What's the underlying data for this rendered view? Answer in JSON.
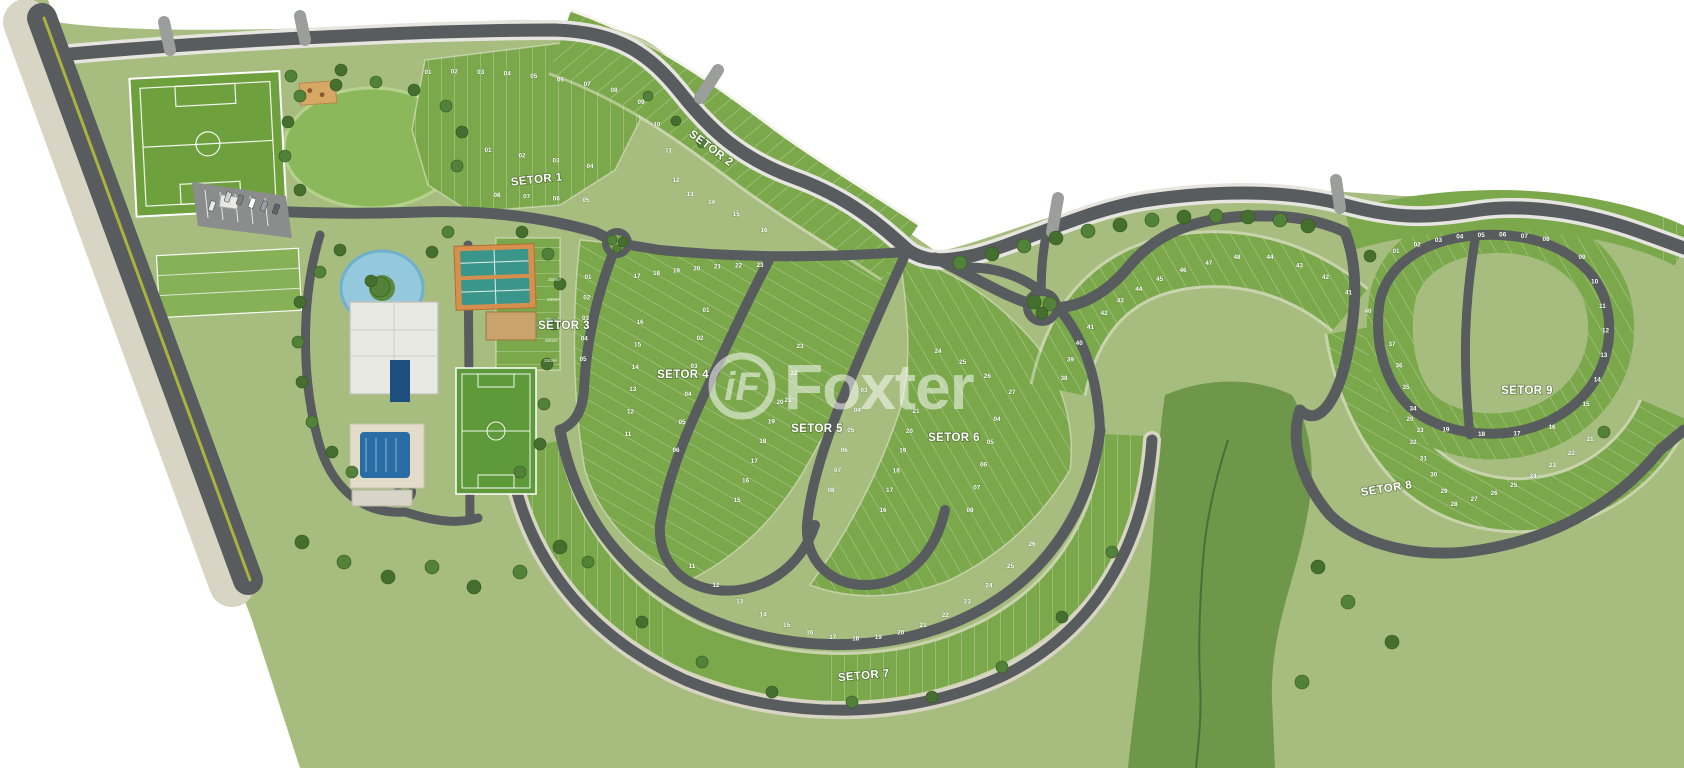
{
  "title": "Condominium master plan map",
  "watermark": {
    "brand": "Foxter",
    "icon_glyph": "iF"
  },
  "sector_labels": [
    {
      "id": "setor-1",
      "label": "SETOR 1",
      "x": 537,
      "y": 183,
      "rot": -6
    },
    {
      "id": "setor-2",
      "label": "SETOR 2",
      "x": 709,
      "y": 151,
      "rot": 37
    },
    {
      "id": "setor-3",
      "label": "SETOR 3",
      "x": 564,
      "y": 329,
      "rot": 0
    },
    {
      "id": "setor-4",
      "label": "SETOR 4",
      "x": 683,
      "y": 378,
      "rot": 0
    },
    {
      "id": "setor-5",
      "label": "SETOR 5",
      "x": 817,
      "y": 432,
      "rot": 0
    },
    {
      "id": "setor-6",
      "label": "SETOR 6",
      "x": 954,
      "y": 441,
      "rot": 0
    },
    {
      "id": "setor-7",
      "label": "SETOR 7",
      "x": 864,
      "y": 679,
      "rot": -5
    },
    {
      "id": "setor-8",
      "label": "SETOR 8",
      "x": 1387,
      "y": 492,
      "rot": -9
    },
    {
      "id": "setor-9",
      "label": "SETOR 9",
      "x": 1527,
      "y": 394,
      "rot": 0
    }
  ],
  "lot_rows": [
    {
      "sector": "setor-1",
      "numbers": [
        "01",
        "02",
        "03",
        "04"
      ],
      "from": [
        488,
        152
      ],
      "to": [
        590,
        168
      ]
    },
    {
      "sector": "setor-1",
      "numbers": [
        "08",
        "07",
        "06",
        "05"
      ],
      "from": [
        497,
        197
      ],
      "to": [
        586,
        202
      ]
    },
    {
      "sector": "setor-2",
      "numbers": [
        "01",
        "02",
        "03",
        "04",
        "05",
        "06",
        "07",
        "08"
      ],
      "from": [
        428,
        74
      ],
      "ctrl": [
        520,
        70
      ],
      "to": [
        614,
        92
      ]
    },
    {
      "sector": "setor-2",
      "numbers": [
        "09",
        "10",
        "11",
        "12"
      ],
      "from": [
        641,
        104
      ],
      "ctrl": [
        668,
        135
      ],
      "to": [
        676,
        182
      ]
    },
    {
      "sector": "setor-2",
      "numbers": [
        "13",
        "14",
        "15",
        "16"
      ],
      "from": [
        690,
        196
      ],
      "ctrl": [
        720,
        205
      ],
      "to": [
        764,
        232
      ]
    },
    {
      "sector": "setor-3",
      "numbers": [
        "01",
        "02",
        "03",
        "04",
        "05"
      ],
      "from": [
        588,
        279
      ],
      "to": [
        583,
        361
      ]
    },
    {
      "sector": "setor-4",
      "numbers": [
        "17",
        "18",
        "19",
        "20",
        "21",
        "22",
        "23"
      ],
      "from": [
        637,
        278
      ],
      "ctrl": [
        695,
        268
      ],
      "to": [
        760,
        267
      ]
    },
    {
      "sector": "setor-4",
      "numbers": [
        "16",
        "15",
        "14",
        "13",
        "12",
        "11"
      ],
      "from": [
        640,
        324
      ],
      "to": [
        628,
        436
      ]
    },
    {
      "sector": "setor-4",
      "numbers": [
        "01",
        "02",
        "03",
        "04",
        "05",
        "06"
      ],
      "from": [
        706,
        312
      ],
      "to": [
        676,
        452
      ]
    },
    {
      "sector": "setor-5",
      "numbers": [
        "23",
        "22",
        "21"
      ],
      "from": [
        800,
        348
      ],
      "to": [
        788,
        402
      ]
    },
    {
      "sector": "setor-5",
      "numbers": [
        "20",
        "19",
        "18",
        "17",
        "16",
        "15"
      ],
      "from": [
        780,
        404
      ],
      "to": [
        737,
        502
      ]
    },
    {
      "sector": "setor-5",
      "numbers": [
        "03",
        "04",
        "05",
        "06",
        "07",
        "08"
      ],
      "from": [
        864,
        392
      ],
      "to": [
        831,
        492
      ]
    },
    {
      "sector": "setor-6",
      "numbers": [
        "21",
        "20",
        "19",
        "18",
        "17",
        "16"
      ],
      "from": [
        916,
        413
      ],
      "to": [
        883,
        512
      ]
    },
    {
      "sector": "setor-6",
      "numbers": [
        "04",
        "05",
        "06",
        "07",
        "08"
      ],
      "from": [
        997,
        421
      ],
      "to": [
        970,
        512
      ]
    },
    {
      "sector": "setor-6",
      "numbers": [
        "24",
        "25",
        "26",
        "27"
      ],
      "from": [
        938,
        353
      ],
      "ctrl": [
        975,
        368
      ],
      "to": [
        1012,
        394
      ]
    },
    {
      "sector": "setor-6",
      "numbers": [
        "38",
        "39",
        "40",
        "41",
        "42",
        "43",
        "44",
        "45",
        "46",
        "47",
        "48"
      ],
      "from": [
        1064,
        380
      ],
      "ctrl": [
        1090,
        285
      ],
      "to": [
        1237,
        259
      ]
    },
    {
      "sector": "setor-8",
      "numbers": [
        "44",
        "43",
        "42",
        "41",
        "40"
      ],
      "from": [
        1270,
        259
      ],
      "ctrl": [
        1332,
        272
      ],
      "to": [
        1368,
        313
      ]
    },
    {
      "sector": "setor-8",
      "numbers": [
        "37",
        "36",
        "35",
        "34",
        "33"
      ],
      "from": [
        1392,
        346
      ],
      "to": [
        1420,
        432
      ]
    },
    {
      "sector": "setor-8",
      "numbers": [
        "32",
        "31",
        "30",
        "29"
      ],
      "from": [
        1413,
        444
      ],
      "to": [
        1444,
        493
      ]
    },
    {
      "sector": "setor-8",
      "numbers": [
        "28",
        "27",
        "26",
        "25",
        "24",
        "23",
        "22",
        "21"
      ],
      "from": [
        1454,
        506
      ],
      "ctrl": [
        1525,
        492
      ],
      "to": [
        1590,
        441
      ]
    },
    {
      "sector": "setor-7",
      "numbers": [
        "11",
        "12",
        "13",
        "14",
        "15",
        "16",
        "17",
        "18",
        "19",
        "20",
        "21",
        "22",
        "23",
        "24",
        "25",
        "26"
      ],
      "from": [
        692,
        568
      ],
      "ctrl": [
        872,
        723
      ],
      "to": [
        1032,
        546
      ]
    },
    {
      "sector": "setor-9",
      "numbers": [
        "01",
        "02",
        "03",
        "04",
        "05",
        "06",
        "07",
        "08"
      ],
      "from": [
        1396,
        253
      ],
      "ctrl": [
        1470,
        228
      ],
      "to": [
        1546,
        241
      ]
    },
    {
      "sector": "setor-9",
      "numbers": [
        "09",
        "10",
        "11",
        "12",
        "13",
        "14",
        "15"
      ],
      "from": [
        1582,
        259
      ],
      "ctrl": [
        1627,
        332
      ],
      "to": [
        1586,
        406
      ]
    },
    {
      "sector": "setor-9",
      "numbers": [
        "16",
        "17",
        "18",
        "19",
        "20"
      ],
      "from": [
        1552,
        429
      ],
      "ctrl": [
        1482,
        447
      ],
      "to": [
        1410,
        421
      ]
    }
  ],
  "area_labels": [
    {
      "text": "250m²",
      "x": 561,
      "y": 281
    },
    {
      "text": "250m²",
      "x": 560,
      "y": 301
    },
    {
      "text": "250m²",
      "x": 559,
      "y": 321
    },
    {
      "text": "250m²",
      "x": 558,
      "y": 342
    },
    {
      "text": "250m²",
      "x": 557,
      "y": 362
    }
  ],
  "trees": [
    [
      960,
      263,
      7
    ],
    [
      992,
      254,
      7
    ],
    [
      1024,
      246,
      7
    ],
    [
      1056,
      238,
      7
    ],
    [
      1088,
      231,
      7
    ],
    [
      1120,
      225,
      7
    ],
    [
      1152,
      220,
      7
    ],
    [
      1184,
      217,
      7
    ],
    [
      1216,
      216,
      7
    ],
    [
      1248,
      217,
      7
    ],
    [
      1280,
      220,
      7
    ],
    [
      1308,
      226,
      7
    ],
    [
      612,
      240,
      5
    ],
    [
      623,
      242,
      5
    ],
    [
      617,
      249,
      4
    ],
    [
      1034,
      302,
      7
    ],
    [
      1050,
      304,
      7
    ],
    [
      1042,
      313,
      6
    ],
    [
      300,
      96,
      6
    ],
    [
      336,
      85,
      6
    ],
    [
      376,
      82,
      6
    ],
    [
      414,
      90,
      6
    ],
    [
      446,
      106,
      6
    ],
    [
      462,
      132,
      6
    ],
    [
      457,
      166,
      6
    ],
    [
      300,
      190,
      6
    ],
    [
      285,
      156,
      6
    ],
    [
      288,
      122,
      6
    ],
    [
      380,
      287,
      10
    ],
    [
      371,
      281,
      6
    ],
    [
      291,
      76,
      6
    ],
    [
      341,
      70,
      6
    ],
    [
      648,
      96,
      5
    ],
    [
      676,
      121,
      5
    ],
    [
      702,
      143,
      5
    ],
    [
      340,
      250,
      6
    ],
    [
      320,
      272,
      6
    ],
    [
      300,
      302,
      6
    ],
    [
      298,
      342,
      6
    ],
    [
      302,
      382,
      6
    ],
    [
      312,
      422,
      6
    ],
    [
      332,
      452,
      6
    ],
    [
      352,
      472,
      6
    ],
    [
      432,
      252,
      6
    ],
    [
      448,
      232,
      6
    ],
    [
      522,
      232,
      6
    ],
    [
      548,
      254,
      6
    ],
    [
      560,
      284,
      6
    ],
    [
      554,
      324,
      6
    ],
    [
      547,
      364,
      6
    ],
    [
      544,
      404,
      6
    ],
    [
      540,
      444,
      6
    ],
    [
      520,
      472,
      6
    ],
    [
      302,
      542,
      7
    ],
    [
      344,
      562,
      7
    ],
    [
      388,
      577,
      7
    ],
    [
      432,
      567,
      7
    ],
    [
      474,
      587,
      7
    ],
    [
      520,
      572,
      7
    ],
    [
      560,
      547,
      7
    ],
    [
      588,
      562,
      6
    ],
    [
      642,
      622,
      6
    ],
    [
      702,
      662,
      6
    ],
    [
      772,
      692,
      6
    ],
    [
      852,
      702,
      6
    ],
    [
      932,
      697,
      6
    ],
    [
      1002,
      667,
      6
    ],
    [
      1062,
      617,
      6
    ],
    [
      1112,
      552,
      6
    ],
    [
      1318,
      567,
      7
    ],
    [
      1348,
      602,
      7
    ],
    [
      1392,
      642,
      7
    ],
    [
      1302,
      682,
      7
    ],
    [
      1370,
      256,
      6
    ],
    [
      1604,
      432,
      6
    ]
  ],
  "vehicles": [
    {
      "x": 228,
      "y": 197,
      "color": "#cfd2d4"
    },
    {
      "x": 240,
      "y": 200,
      "color": "#7b8287"
    },
    {
      "x": 252,
      "y": 203,
      "color": "#ffffff"
    },
    {
      "x": 264,
      "y": 206,
      "color": "#9aa0a4"
    },
    {
      "x": 276,
      "y": 209,
      "color": "#5d6468"
    },
    {
      "x": 212,
      "y": 206,
      "color": "#e8e8e6"
    }
  ],
  "colors": {
    "land": "#a6bd7f",
    "lots": "#7aa84b",
    "preserve": "#6f9749",
    "road": "#585c5e",
    "sidewalk": "#d9d5c4",
    "water": "#94c8dc",
    "pool": "#2a6da5",
    "court": "#3a968b",
    "court_border": "#d78f4e",
    "field": "#679c3d",
    "median": "#a9b43c",
    "tree": "#456f2e"
  }
}
